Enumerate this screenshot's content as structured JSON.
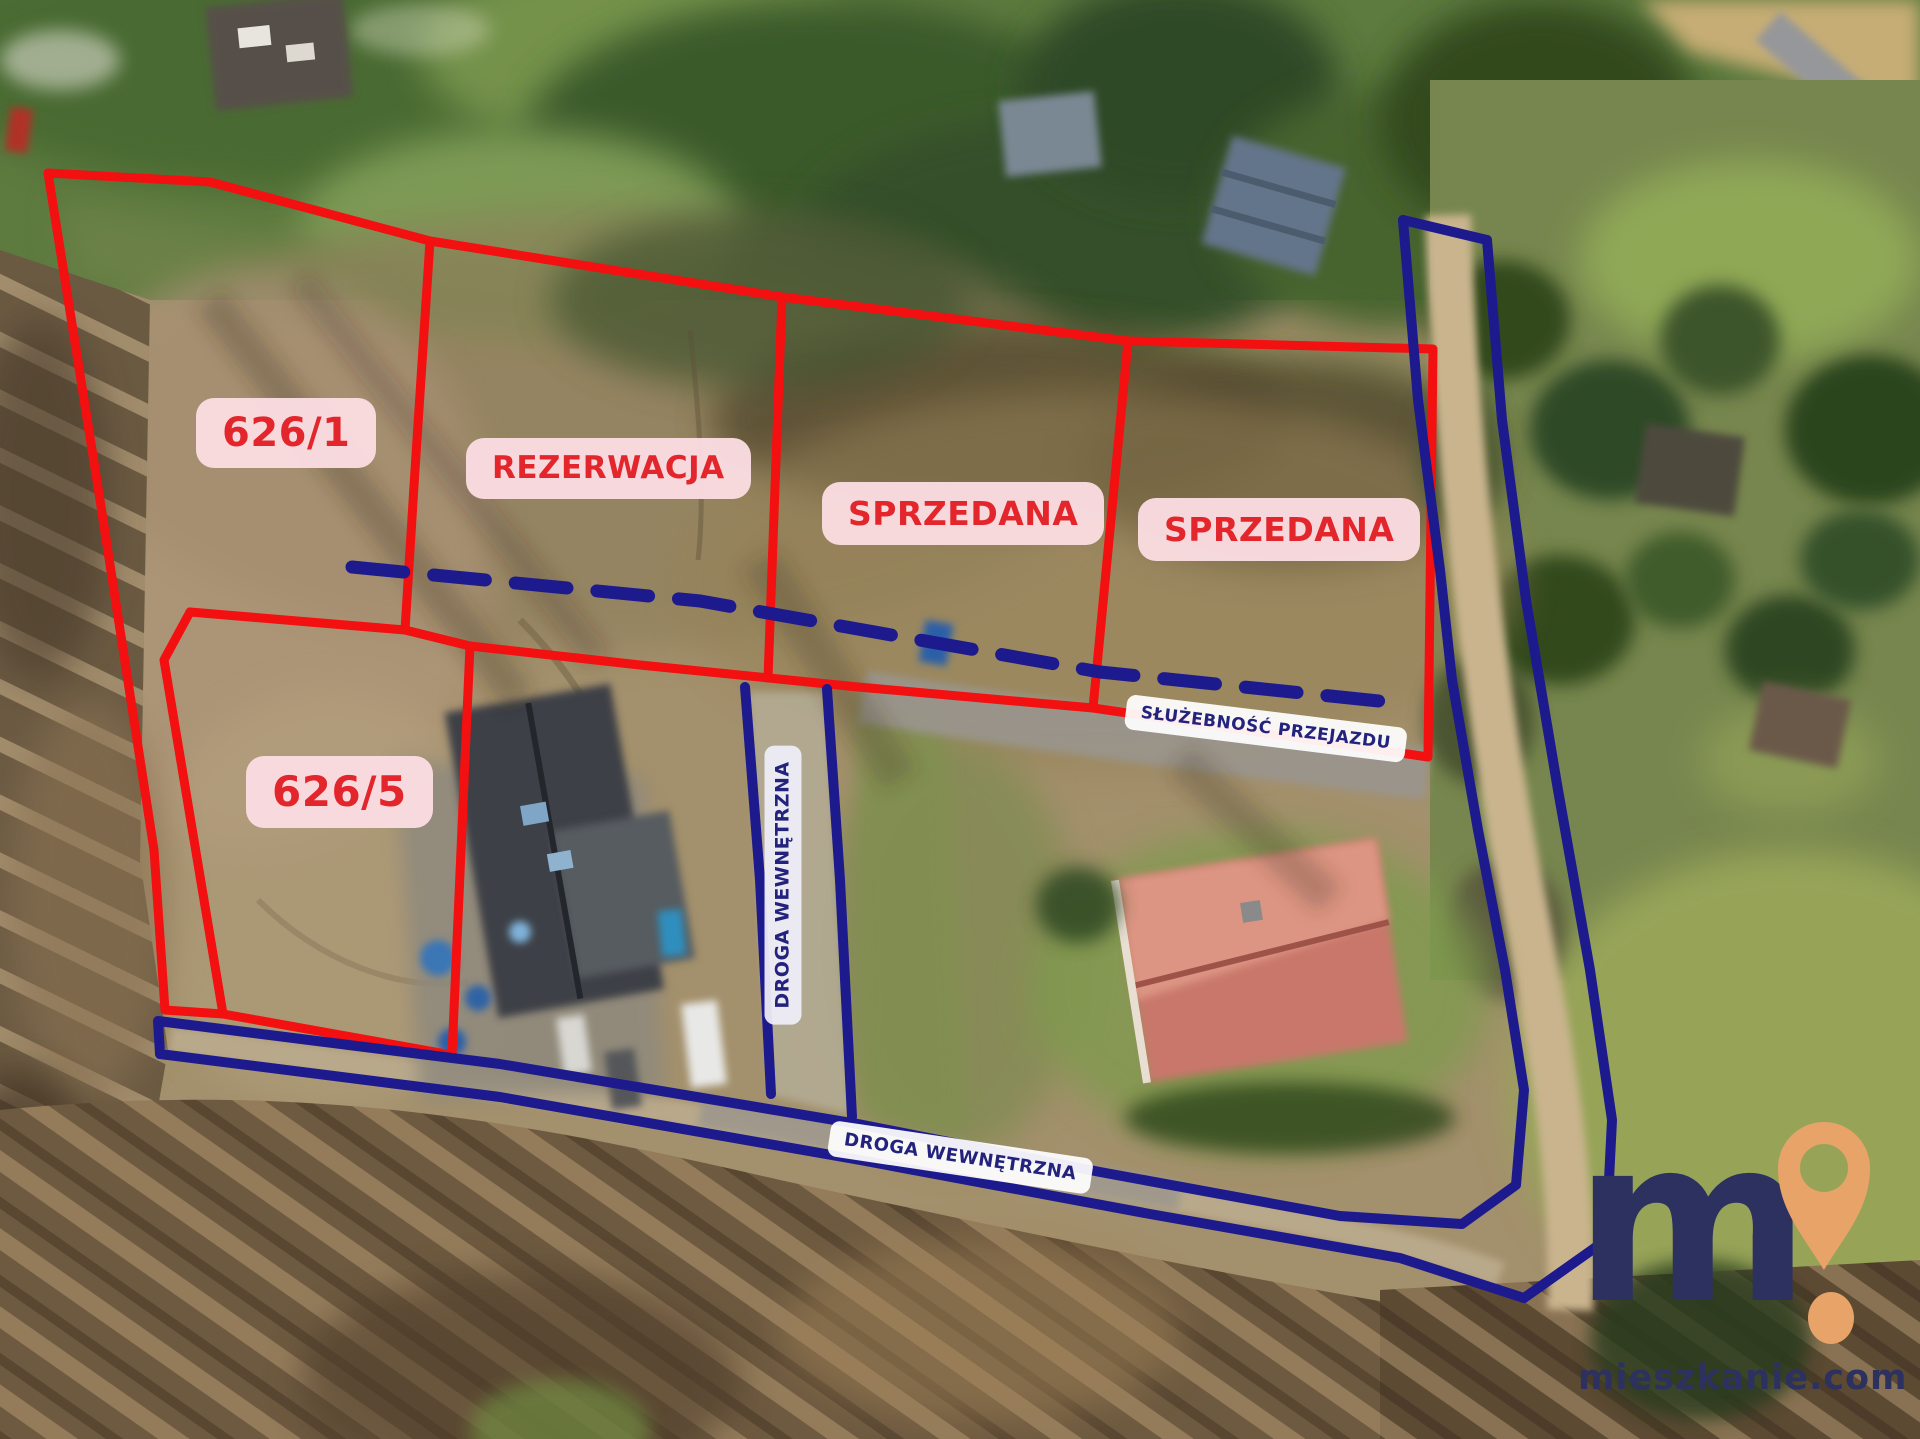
{
  "plots": [
    {
      "label": "626/1"
    },
    {
      "label": "REZERWACJA"
    },
    {
      "label": "SPRZEDANA"
    },
    {
      "label": "SPRZEDANA"
    },
    {
      "label": "626/5"
    }
  ],
  "easement": {
    "label": "SŁUŻEBNOŚĆ PRZEJAZDU"
  },
  "roads": {
    "vertical_label": "DROGA WEWNĘTRZNA",
    "bottom_label": "DROGA WEWNĘTRZNA"
  },
  "logo": {
    "letter": "m",
    "mark_icon": "map-pin-exclamation-icon",
    "site": "mieszkanie.com"
  },
  "colors": {
    "plot_line_red": "#f21010",
    "label_pill_pink": "#fbdde2",
    "label_text_red": "#e2262b",
    "road_line_navy": "#1d1a8e",
    "label_text_navy": "#23237d",
    "logo_navy": "#2d3160",
    "logo_orange": "#e7a368"
  }
}
